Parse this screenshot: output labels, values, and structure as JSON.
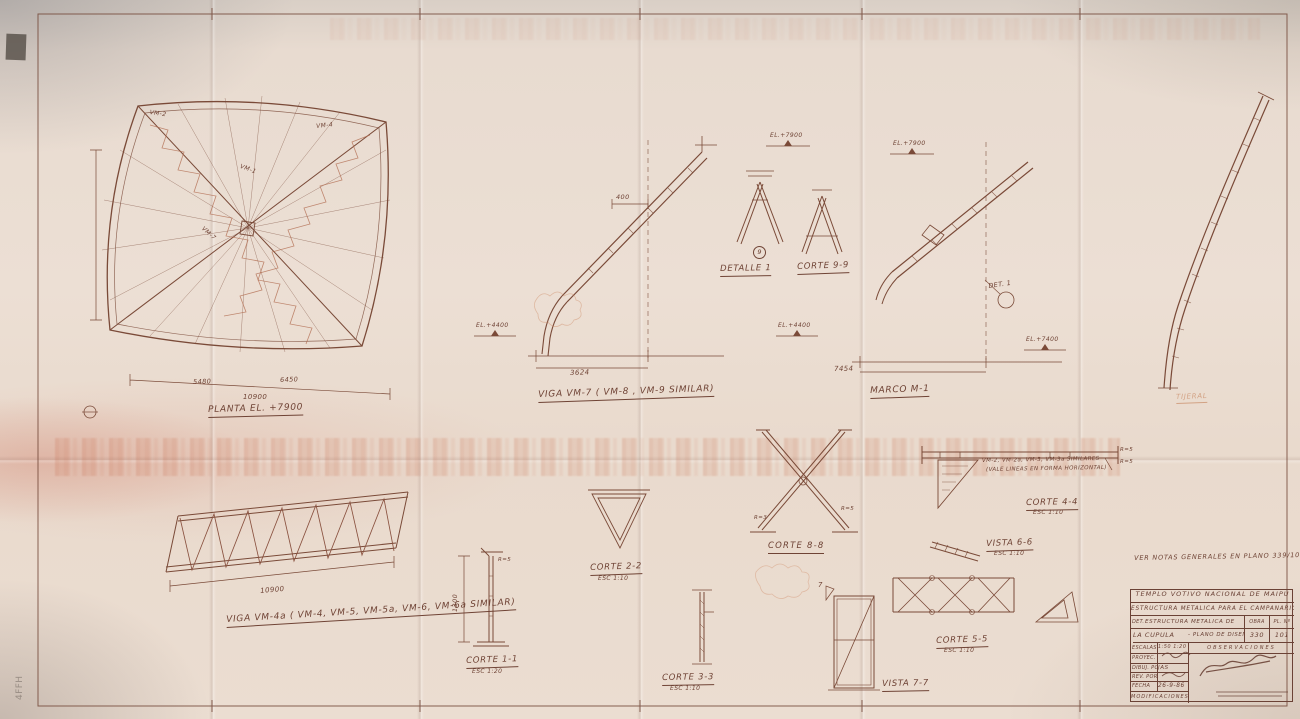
{
  "sheet": {
    "pencil_note": "4FFH"
  },
  "notes": {
    "general": "VER NOTAS GENERALES EN PLANO 339/100",
    "tijeral": "TIJERAL",
    "beam_note_1": "VM-2, VM-2a, VM-3, VM-3a SIMILARES",
    "beam_note_2": "(VALE LINEAS EN FORMA HORIZONTAL)"
  },
  "elevations": {
    "el_7900_a": "EL.+7900",
    "el_7900_b": "EL.+7900",
    "el_4400_a": "EL.+4400",
    "el_4400_b": "EL.+4400",
    "el_7400": "EL.+7400"
  },
  "figures": {
    "planta": {
      "caption": "PLANTA  EL. +7900",
      "dim_total": "10900",
      "dim_a": "5480",
      "dim_b": "6450",
      "tag_vm2": "VM-2",
      "tag_vm4": "VM-4",
      "tag_vm1": "VM-1",
      "tag_vm7": "VM-7"
    },
    "viga_vm4a": {
      "caption": "VIGA VM-4a ( VM-4, VM-5, VM-5a, VM-6, VM-6a SIMILAR)",
      "dim": "10900"
    },
    "viga_vm7": {
      "caption": "VIGA VM-7 ( VM-8 , VM-9 SIMILAR)",
      "dim": "3624",
      "dim_top": "400"
    },
    "marco_m1": {
      "caption": "MARCO  M-1",
      "dim": "7454",
      "det_note": "DET. 1"
    },
    "detalle_1": {
      "caption": "DETALLE 1",
      "marker": "9"
    },
    "corte_9_9": {
      "caption": "CORTE 9-9"
    },
    "corte_1_1": {
      "caption": "CORTE 1-1",
      "scale": "ESC 1:20",
      "dim": "1300",
      "note": "R=5"
    },
    "corte_2_2": {
      "caption": "CORTE 2-2",
      "scale": "ESC 1:10"
    },
    "corte_3_3": {
      "caption": "CORTE 3-3",
      "scale": "ESC 1:10"
    },
    "corte_8_8": {
      "caption": "CORTE 8-8",
      "note_left": "R=3",
      "note_right": "R=5"
    },
    "corte_5_5": {
      "caption": "CORTE 5-5",
      "scale": "ESC 1:10"
    },
    "corte_4_4": {
      "caption": "CORTE 4-4",
      "scale": "ESC 1:10",
      "note_r1": "R=5",
      "note_r2": "R=5"
    },
    "vista_6_6": {
      "caption": "VISTA 6-6",
      "scale": "ESC 1:10"
    },
    "vista_7_7": {
      "caption": "VISTA 7-7",
      "marker": "7"
    }
  },
  "title_block": {
    "project_line1": "TEMPLO VOTIVO NACIONAL DE MAIPU",
    "project_line2": "ESTRUCTURA METALICA PARA EL CAMPANARIO",
    "det_label": "DET.",
    "subject_line1": "ESTRUCTURA METALICA DE",
    "subject_line2": "LA CUPULA",
    "subject_line2b": "- PLANO DE DISEÑO",
    "obra_label": "OBRA",
    "obra_value": "330",
    "pl_label": "PL. Nº",
    "pl_value": "101",
    "escalas_label": "ESCALAS",
    "escalas_value": "1:50 1:20 1:10",
    "observaciones_label": "OBSERVACIONES",
    "proy_label": "PROYEC. POR",
    "dibu_label": "DIBUJ. POR",
    "dibu_value": "JAS",
    "rev_label": "REV. POR",
    "fecha_label": "FECHA",
    "fecha_value": "26-9-86",
    "modificaciones_label": "MODIFICACIONES"
  }
}
